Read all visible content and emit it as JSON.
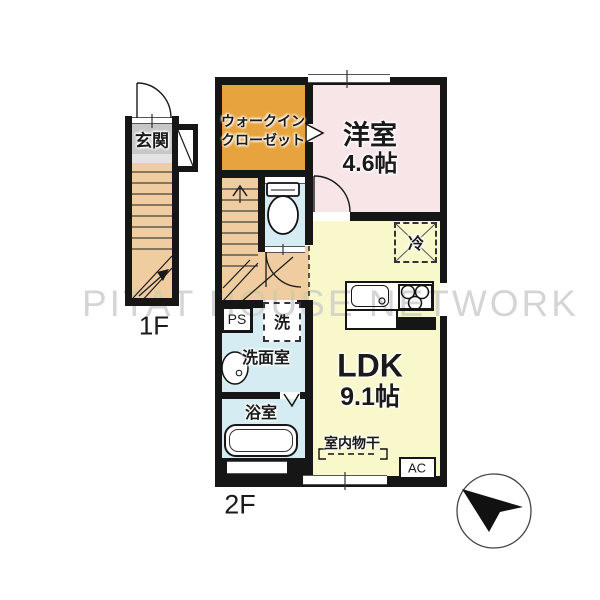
{
  "labels": {
    "watermark": "PITAT HOUSE NETWORK",
    "floor1": "1F",
    "floor2": "2F",
    "genkan": "玄関",
    "wic1": "ウォークイン",
    "wic2": "クローゼット",
    "western": "洋室",
    "western_size": "4.6帖",
    "ldk": "LDK",
    "ldk_size": "9.1帖",
    "senmen": "洗面室",
    "bath": "浴室",
    "ps": "PS",
    "washer": "洗",
    "fridge": "冷",
    "ac": "AC",
    "drying": "室内物干"
  },
  "colors": {
    "wall": "#161616",
    "wic": "#e7a43e",
    "western": "#f8e5e8",
    "ldk": "#f9f8ca",
    "water": "#d5edf2",
    "wood": "#f0cda1",
    "tile": "#c7c7c7",
    "watermark": "#d5d5d5"
  }
}
